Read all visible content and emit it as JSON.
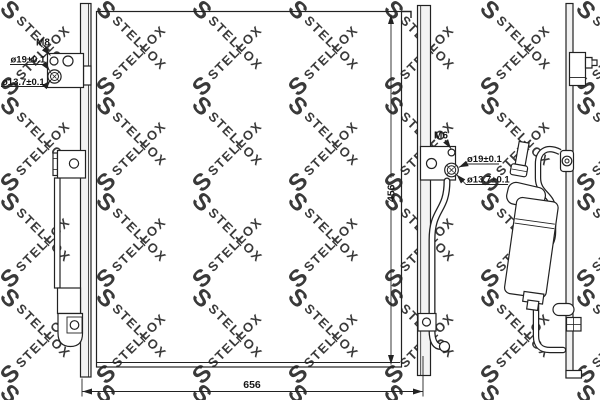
{
  "watermark": {
    "brand": "STELLOX",
    "logo_letter": "S",
    "color": "#d9d9d9"
  },
  "callouts": {
    "left_bracket": {
      "thread_label": "M8",
      "outer_diameter_label": "ø19±0.1",
      "inner_diameter_label": "ø13.7±0.1"
    },
    "right_bracket": {
      "thread_label": "M6",
      "outer_diameter_label": "ø19±0.1",
      "inner_diameter_label": "ø13.7±0.1"
    }
  },
  "dimensions": {
    "core_height_label": "456",
    "overall_width_label": "656"
  },
  "colors": {
    "line": "#222222",
    "fill_light": "#f3f3f3"
  }
}
